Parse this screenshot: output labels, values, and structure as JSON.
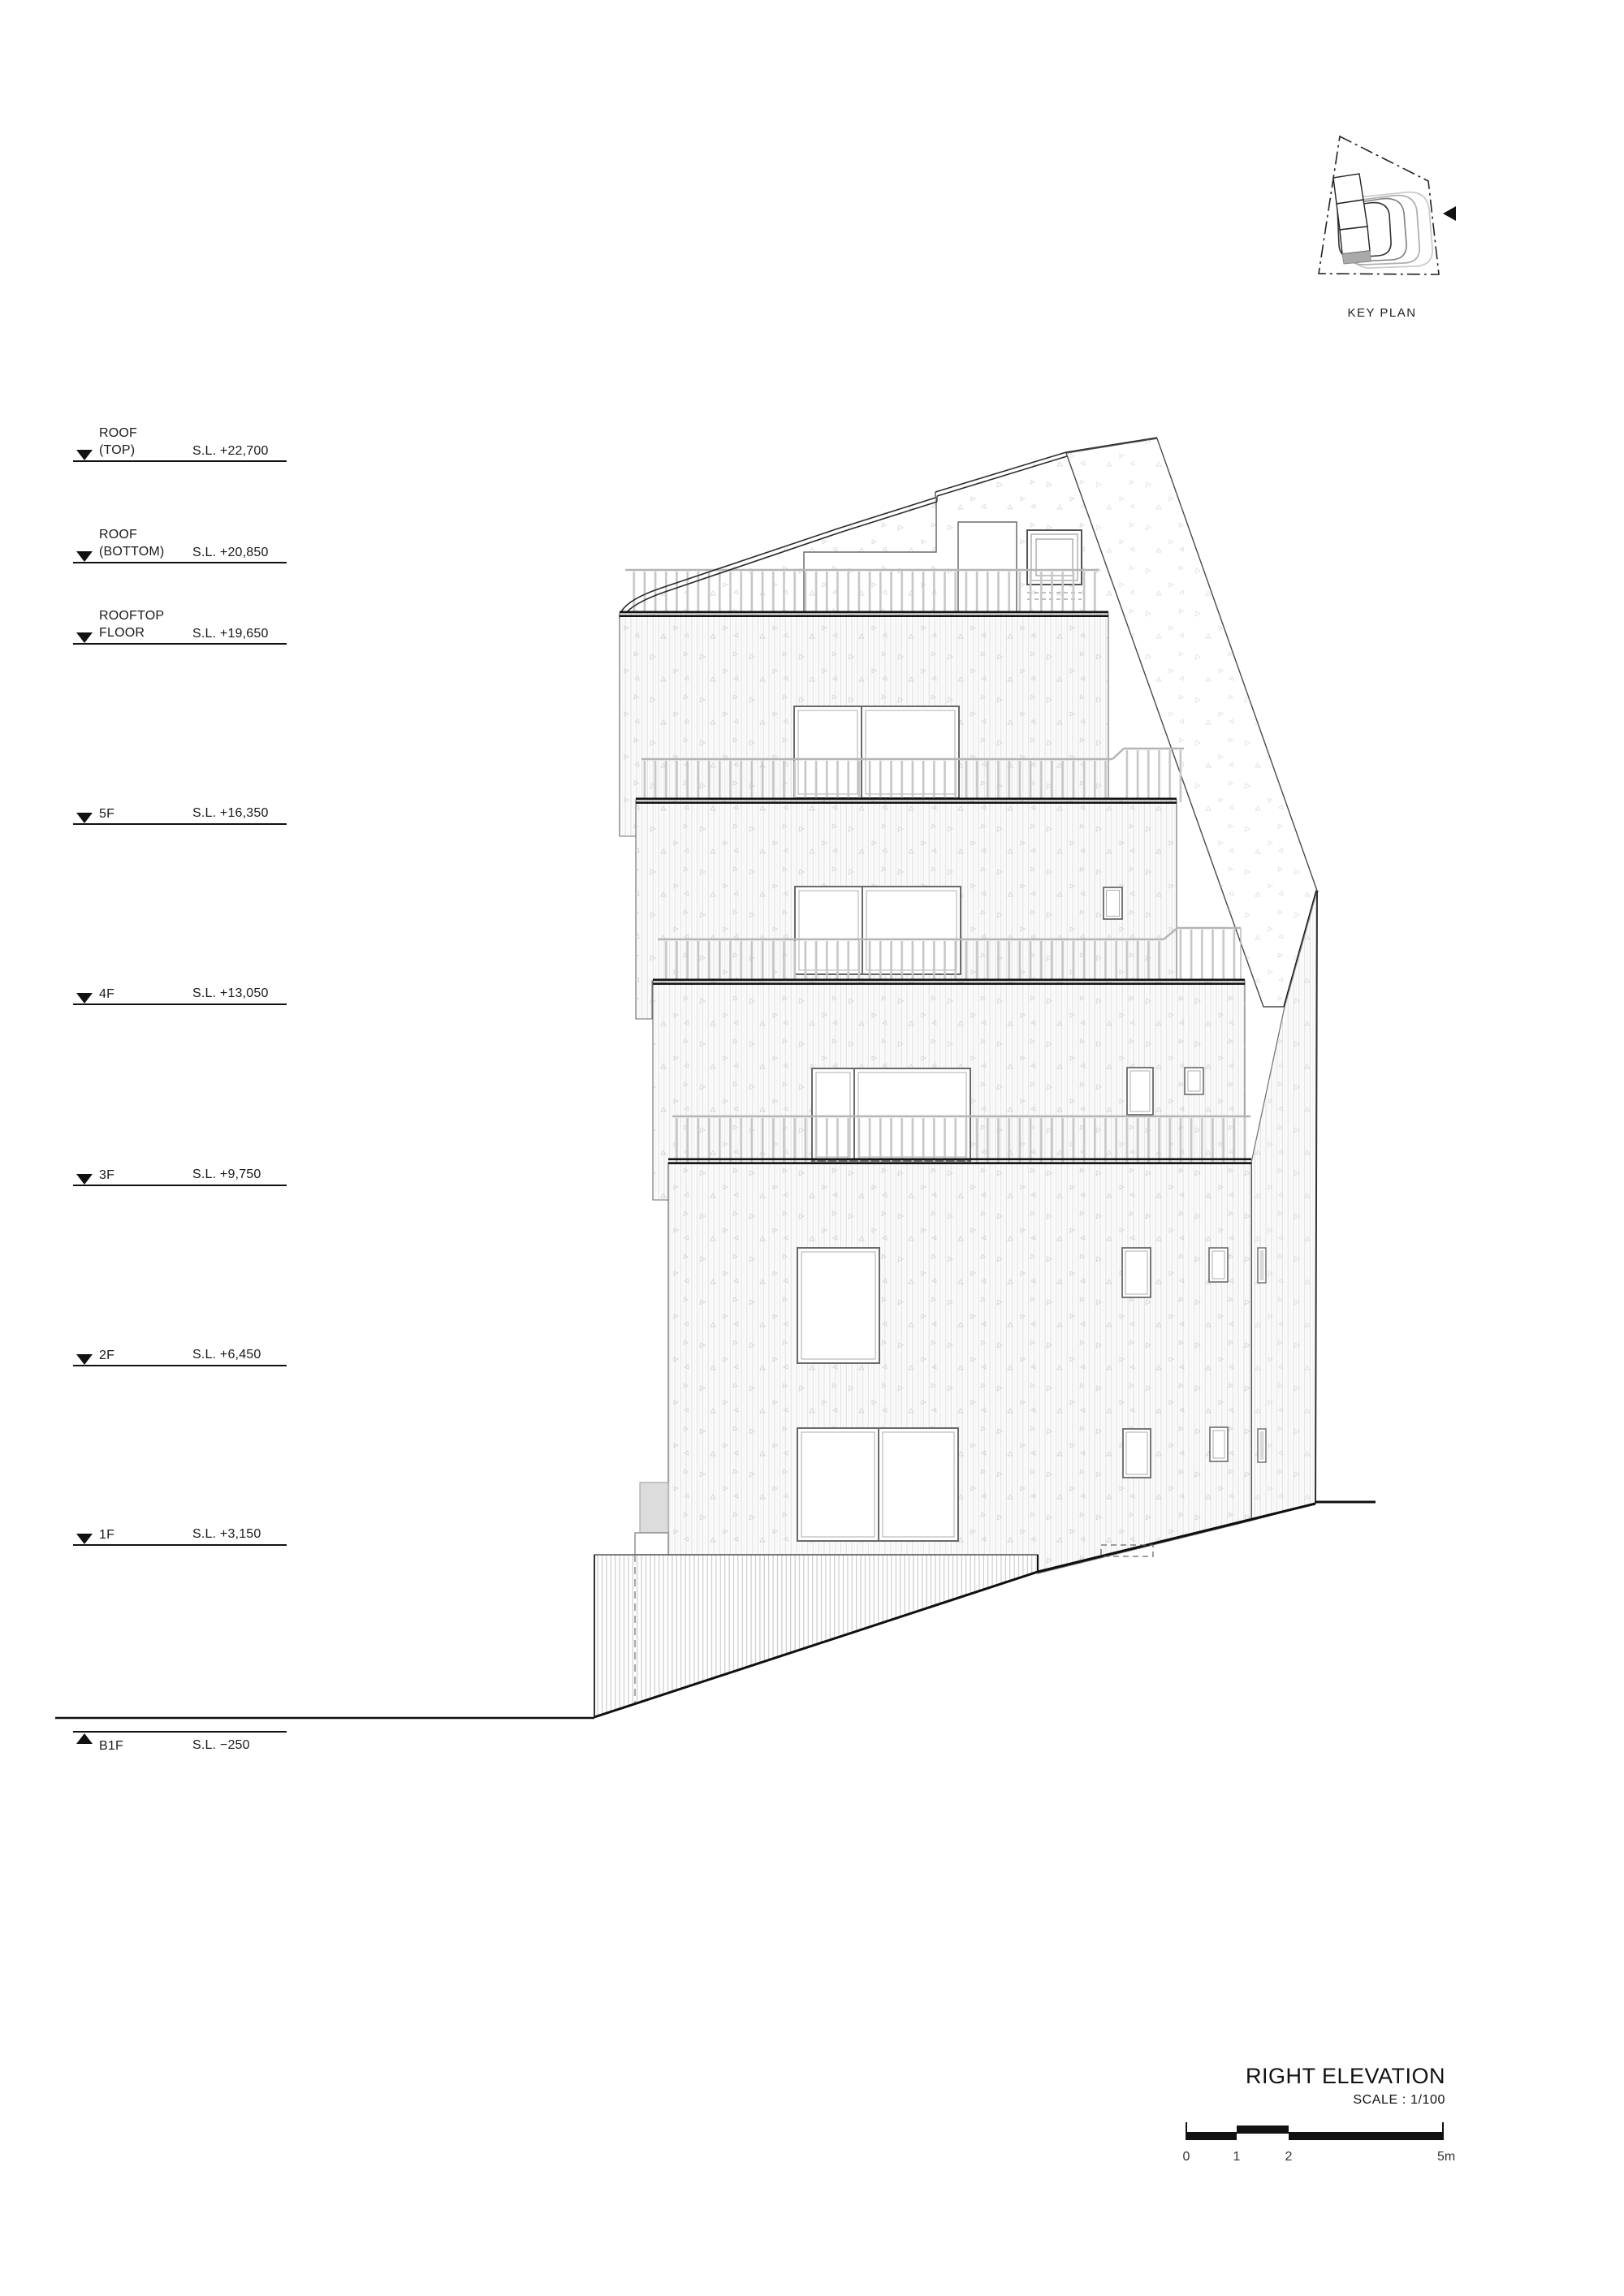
{
  "key_plan": {
    "label": "KEY PLAN"
  },
  "levels": {
    "roof_top": {
      "line1": "ROOF",
      "line2": "(TOP)",
      "value": "S.L. +22,700"
    },
    "roof_bottom": {
      "line1": "ROOF",
      "line2": "(BOTTOM)",
      "value": "S.L. +20,850"
    },
    "rooftop_floor": {
      "line1": "ROOFTOP",
      "line2": "FLOOR",
      "value": "S.L. +19,650"
    },
    "f5": {
      "line1": "5F",
      "value": "S.L. +16,350"
    },
    "f4": {
      "line1": "4F",
      "value": "S.L. +13,050"
    },
    "f3": {
      "line1": "3F",
      "value": "S.L. +9,750"
    },
    "f2": {
      "line1": "2F",
      "value": "S.L. +6,450"
    },
    "f1": {
      "line1": "1F",
      "value": "S.L. +3,150"
    },
    "b1f": {
      "line1": "B1F",
      "value": "S.L. −250"
    }
  },
  "title_block": {
    "title": "RIGHT ELEVATION",
    "scale": "SCALE : 1/100"
  },
  "scale_bar": {
    "ticks": [
      "0",
      "1",
      "2",
      "5m"
    ]
  },
  "colors": {
    "line": "#111111",
    "railing": "#c7c7c7",
    "siding": "#e2e2e2"
  }
}
